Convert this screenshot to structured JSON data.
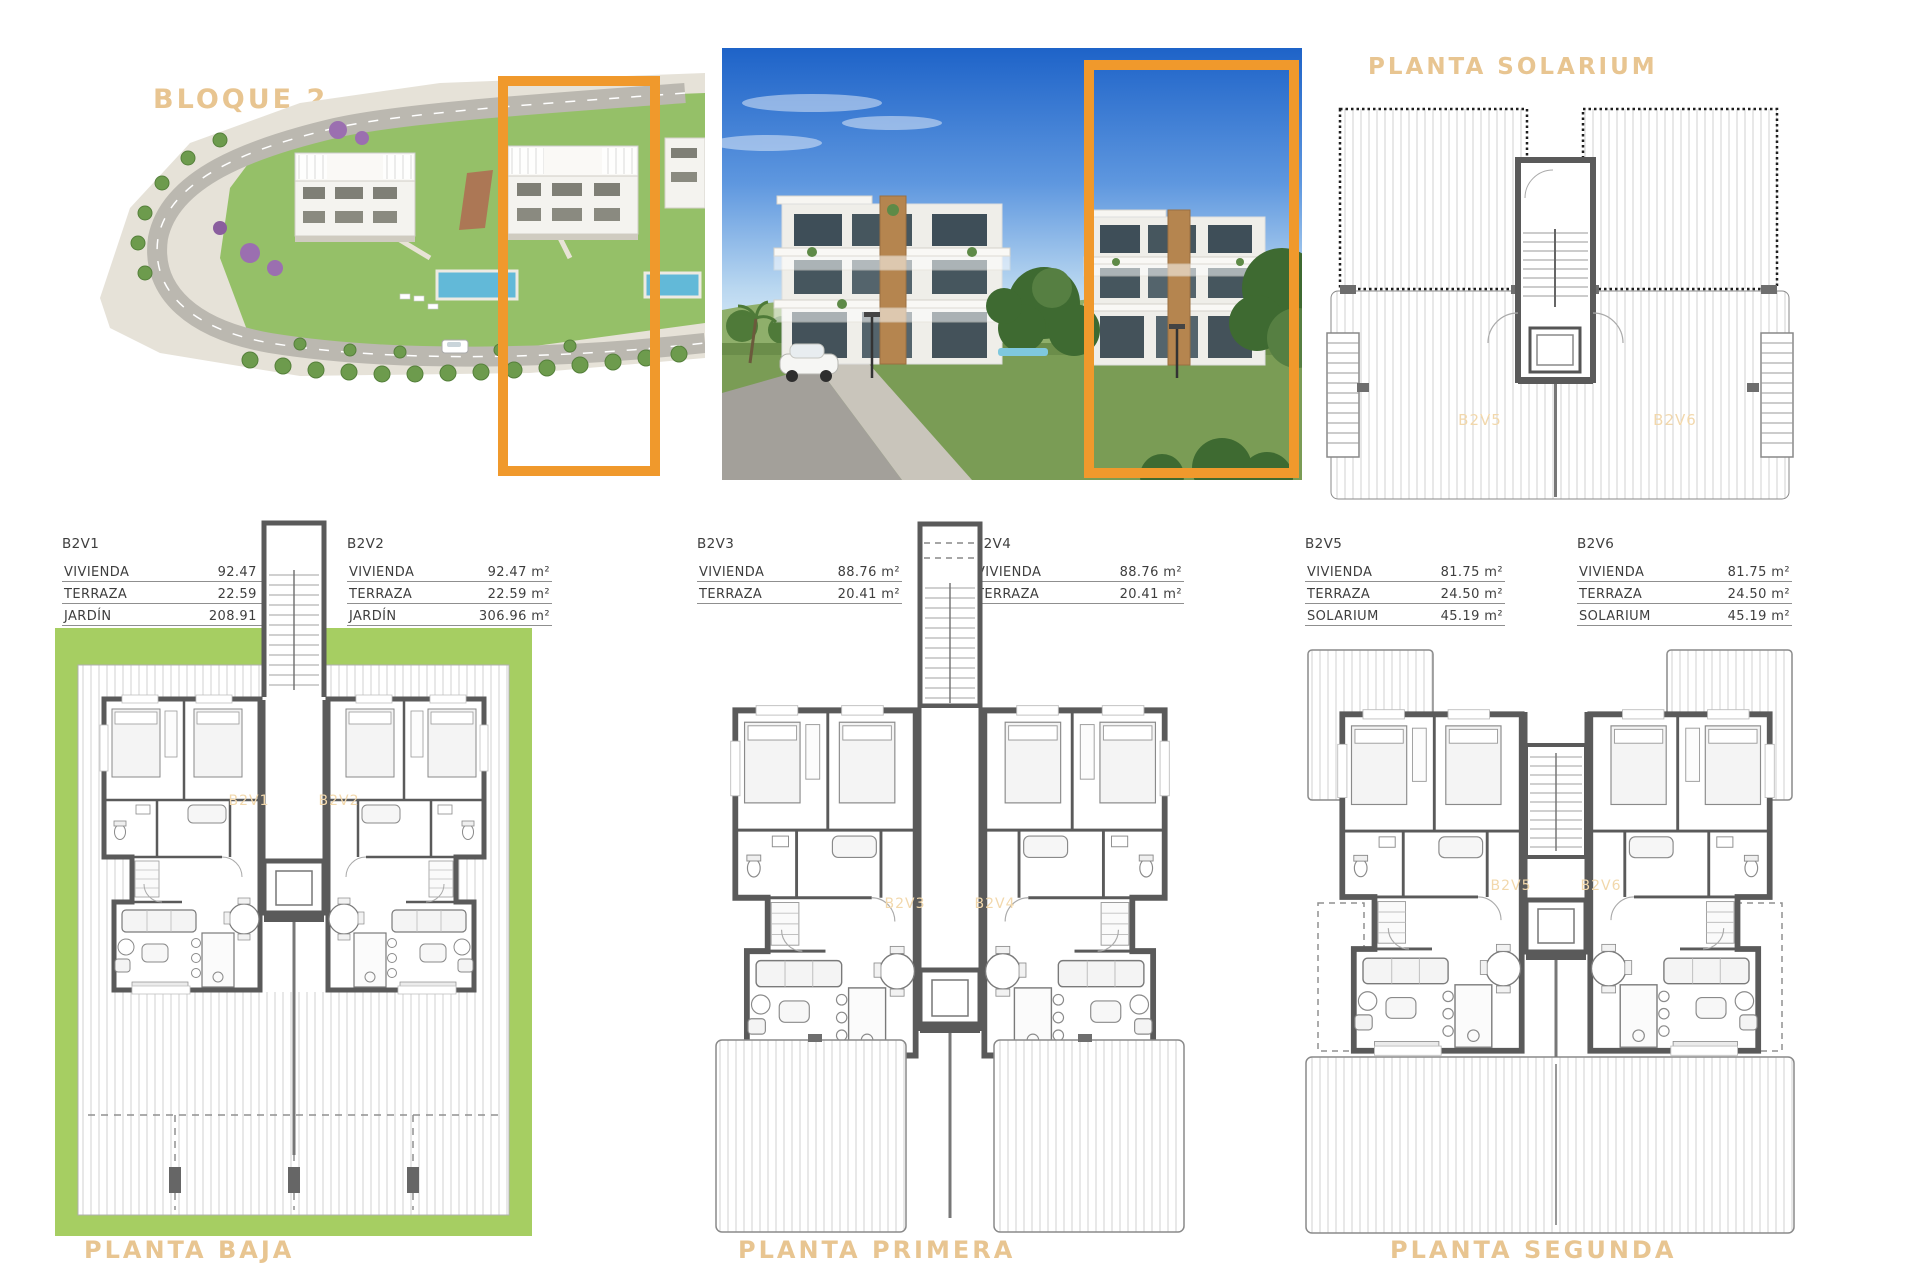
{
  "palette": {
    "frame_orange": "#F0992C",
    "title_tan": "#E8C591",
    "plan_label_orange": "#F2D8AC",
    "garden_green": "#A6CE62",
    "wall_gray": "#5A5A5A"
  },
  "labels": {
    "bloque": "BLOQUE 2",
    "solarium_title": "PLANTA SOLARIUM",
    "baja": "PLANTA BAJA",
    "primera": "PLANTA PRIMERA",
    "segunda": "PLANTA SEGUNDA"
  },
  "unit_tables": [
    {
      "id": "B2V1",
      "rows": [
        [
          "VIVIENDA",
          "92.47 m²"
        ],
        [
          "TERRAZA",
          "22.59 m²"
        ],
        [
          "JARDÍN",
          "208.91 m²"
        ]
      ]
    },
    {
      "id": "B2V2",
      "rows": [
        [
          "VIVIENDA",
          "92.47 m²"
        ],
        [
          "TERRAZA",
          "22.59 m²"
        ],
        [
          "JARDÍN",
          "306.96 m²"
        ]
      ]
    },
    {
      "id": "B2V3",
      "rows": [
        [
          "VIVIENDA",
          "88.76 m²"
        ],
        [
          "TERRAZA",
          "20.41 m²"
        ]
      ]
    },
    {
      "id": "B2V4",
      "rows": [
        [
          "VIVIENDA",
          "88.76 m²"
        ],
        [
          "TERRAZA",
          "20.41 m²"
        ]
      ]
    },
    {
      "id": "B2V5",
      "rows": [
        [
          "VIVIENDA",
          "81.75 m²"
        ],
        [
          "TERRAZA",
          "24.50 m²"
        ],
        [
          "SOLARIUM",
          "45.19 m²"
        ]
      ]
    },
    {
      "id": "B2V6",
      "rows": [
        [
          "VIVIENDA",
          "81.75 m²"
        ],
        [
          "TERRAZA",
          "24.50 m²"
        ],
        [
          "SOLARIUM",
          "45.19 m²"
        ]
      ]
    }
  ],
  "plan_unit_labels": {
    "solarium": [
      "B2V5",
      "B2V6"
    ],
    "baja": [
      "B2V1",
      "B2V2"
    ],
    "primera": [
      "B2V3",
      "B2V4"
    ],
    "segunda": [
      "B2V5",
      "B2V6"
    ]
  }
}
